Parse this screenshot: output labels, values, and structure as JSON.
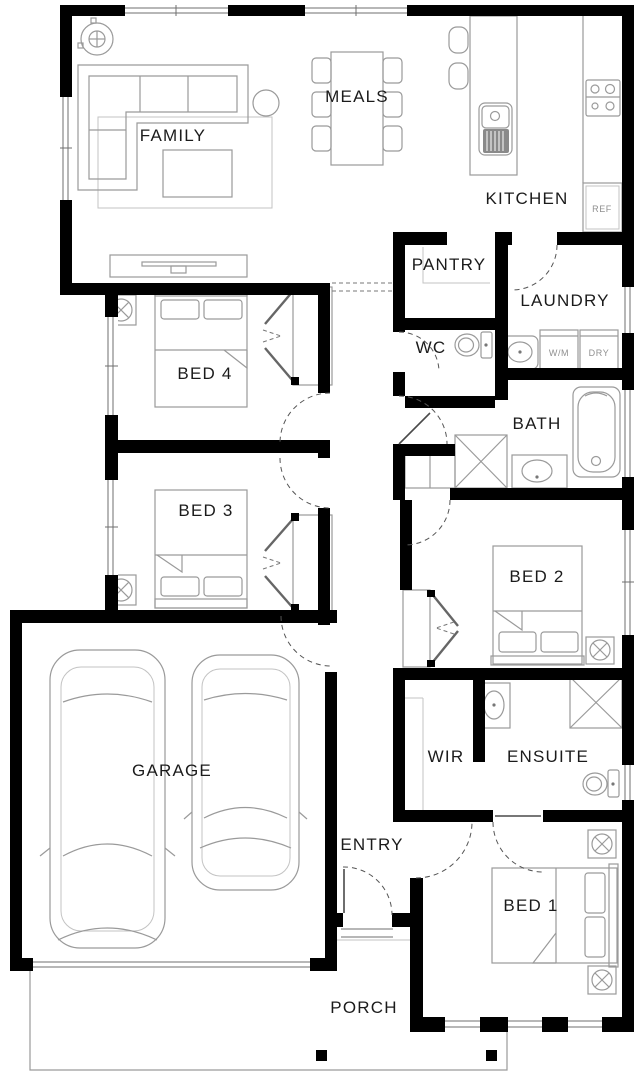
{
  "plan": {
    "title": "single-storey house floor plan",
    "rooms": {
      "family": "FAMILY",
      "meals": "MEALS",
      "kitchen": "KITCHEN",
      "pantry": "PANTRY",
      "laundry": "LAUNDRY",
      "wc": "WC",
      "bed4": "BED 4",
      "bath": "BATH",
      "bed3": "BED 3",
      "bed2": "BED 2",
      "garage": "GARAGE",
      "wir": "WIR",
      "ensuite": "ENSUITE",
      "entry": "ENTRY",
      "bed1": "BED 1",
      "porch": "PORCH"
    },
    "appliances": {
      "ref": "REF",
      "wm": "W/M",
      "dry": "DRY"
    },
    "colors": {
      "wall": "#000000",
      "furniture_line": "#9a9a9a",
      "label_text": "#1b1b1b",
      "small_label_text": "#8f8f8f",
      "background": "#ffffff"
    }
  }
}
